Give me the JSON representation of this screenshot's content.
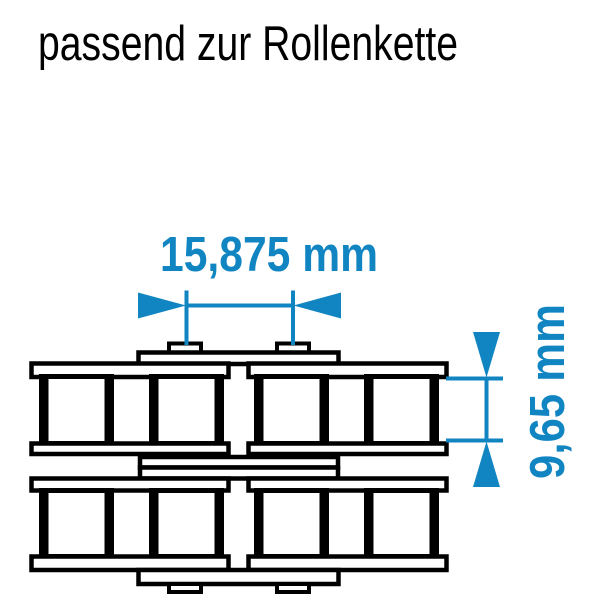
{
  "title": "passend zur Rollenkette",
  "dimensions": {
    "pitch": {
      "label": "15,875 mm",
      "orientation": "horizontal"
    },
    "inner_width": {
      "label": "9,65 mm",
      "orientation": "vertical"
    }
  },
  "drawing": {
    "subject": "duplex-roller-chain-top-view"
  },
  "colors": {
    "dimension_blue": "#1185c2",
    "drawing_black": "#000000",
    "background": "#ffffff"
  }
}
